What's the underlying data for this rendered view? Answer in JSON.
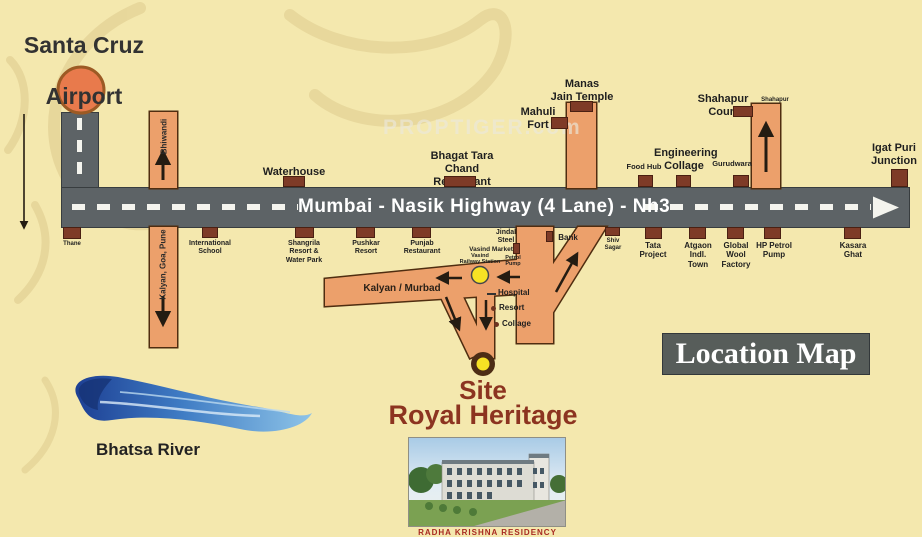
{
  "page": {
    "title_line1": "Santa Cruz",
    "title_line2": "Airport",
    "watermark": "PROPTIGER.com",
    "location_map": "Location Map"
  },
  "highway": {
    "label": "Mumbai - Nasik Highway (4 Lane) - Nh3"
  },
  "roads": {
    "bhiwandi": "Bhiwandi",
    "kalyan_goa_pune": "Kalyan, Goa, Pune",
    "kalyan_murbad": "Kalyan / Murbad",
    "shahapur_small": "Shahapur"
  },
  "above_highway": {
    "waterhouse": "Waterhouse",
    "bhagat": "Bhagat Tara Chand\nRestaurant",
    "mahuli": "Mahuli\nFort",
    "manas": "Manas\nJain Temple",
    "food_hub": "Food Hub",
    "engineering": "Engineering\nCollage",
    "gurudwara": "Gurudwara",
    "shahapur_court": "Shahapur\nCourt",
    "igatpuri": "Igat Puri\nJunction"
  },
  "below_highway": {
    "thane": "Thane",
    "international_school": "International\nSchool",
    "shangrila": "Shangrila\nResort &\nWater Park",
    "pushkar": "Pushkar\nResort",
    "punjab": "Punjab\nRestaurant",
    "jindal": "Jindal\nSteel",
    "vasind_market": "Vasind Market",
    "petrol_pump_small": "Petrol\nPump",
    "bank": "Bank",
    "shiv_sagar": "Shiv\nSagar",
    "tata": "Tata\nProject",
    "atgaon": "Atgaon\nIndl.\nTown",
    "global_wool": "Global\nWool\nFactory",
    "hp_petrol": "HP Petrol\nPump",
    "kasara": "Kasara\nGhat"
  },
  "site_area": {
    "vasind_station": "Vasind\nRailway Station",
    "hospital": "Hospital",
    "resort": "Resort",
    "collage": "Collage",
    "site": "Site",
    "site_name": "Royal Heritage",
    "photo_caption": "RADHA KRISHNA RESIDENCY"
  },
  "river": {
    "label": "Bhatsa River"
  },
  "colors": {
    "background": "#f4e8ae",
    "highway_gray": "#5d6366",
    "road_orange": "#eca06b",
    "marker_brown": "#7e3b27",
    "site_text": "#8c3420",
    "circle_yellow": "#f7e224",
    "airport_orange": "#e87a4c",
    "river_blue": "#2a55a8"
  }
}
